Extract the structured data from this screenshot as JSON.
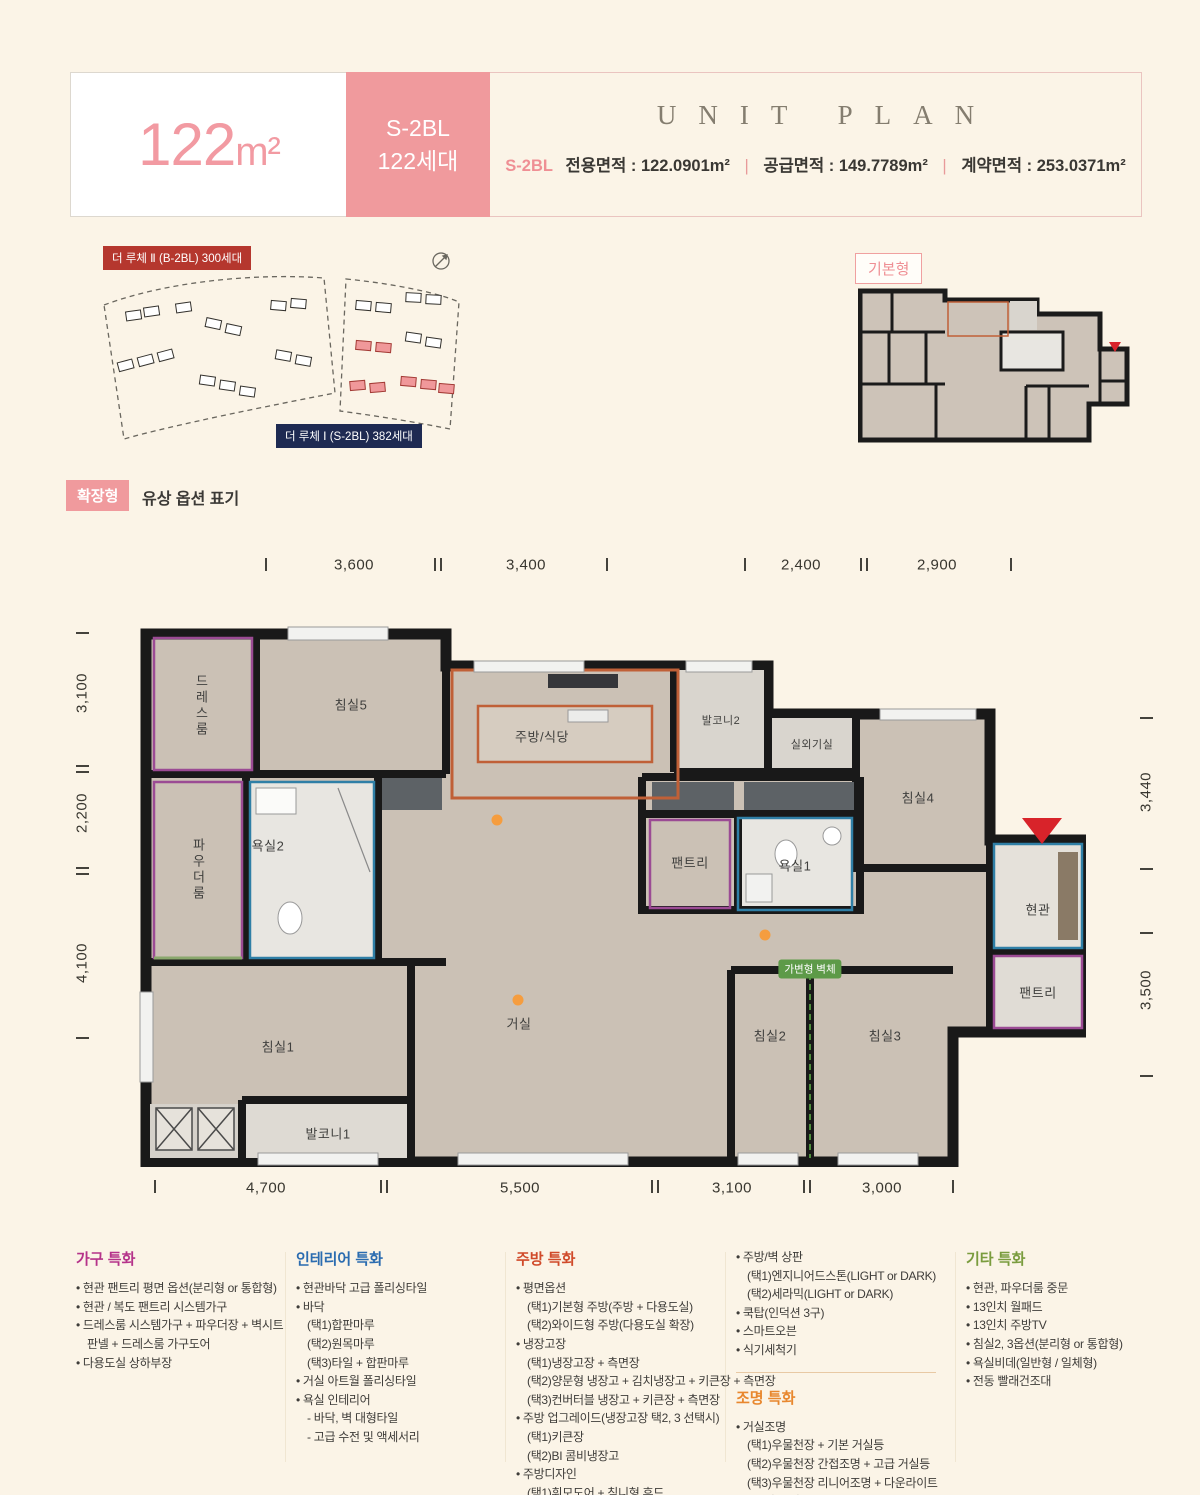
{
  "header": {
    "size_number": "122",
    "size_unit": "m²",
    "block_badge_line1": "S-2BL",
    "block_badge_line2": "122세대",
    "unit_plan_title": "UNIT PLAN",
    "block_code": "S-2BL",
    "areas": [
      {
        "label": "전용면적",
        "value": "122.0901m²"
      },
      {
        "label": "공급면적",
        "value": "149.7789m²"
      },
      {
        "label": "계약면적",
        "value": "253.0371m²"
      }
    ]
  },
  "site_map": {
    "label_block2": "더 루체 Ⅱ (B-2BL) 300세대",
    "label_block1": "더 루체 Ⅰ (S-2BL) 382세대",
    "compass_icon": "compass-icon"
  },
  "basic_type_label": "기본형",
  "option_row": {
    "badge": "확장형",
    "text": "유상 옵션 표기"
  },
  "plan": {
    "dims_top": [
      "3,600",
      "3,400",
      "2,400",
      "2,900"
    ],
    "dims_bottom": [
      "4,700",
      "5,500",
      "3,100",
      "3,000"
    ],
    "dims_left": [
      "3,100",
      "2,200",
      "4,100"
    ],
    "dims_right": [
      "3,440",
      "3,500"
    ],
    "rooms": {
      "dress": "드레스룸",
      "bed5": "침실5",
      "kitchen": "주방/식당",
      "balc2": "발코니2",
      "outdoor": "실외기실",
      "bed4": "침실4",
      "powder": "파우더룸",
      "bath2": "욕실2",
      "pantry1": "팬트리",
      "bath1": "욕실1",
      "entry": "현관",
      "pantry2": "팬트리",
      "bed1": "침실1",
      "living": "거실",
      "bed2": "침실2",
      "bed3": "침실3",
      "balc1": "발코니1"
    },
    "wall_badge": "가변형 벽체"
  },
  "colors": {
    "accent_pink": "#f09a9d",
    "deep_red_label": "#b5372e",
    "navy_label": "#1e2a52",
    "green_badge": "#5d9a48",
    "orange_dot": "#f59d3f",
    "kitchen_outline": "#c06037",
    "purple_outline": "#9b4b94",
    "blue_outline": "#2f7fa6",
    "entry_arrow_red": "#d8232a"
  },
  "features": {
    "columns": [
      {
        "sections": [
          {
            "title": "가구 특화",
            "color": "#b5338a",
            "items": [
              {
                "b": 1,
                "t": "현관 팬트리 평면 옵션(분리형 or 통합형)"
              },
              {
                "b": 1,
                "t": "현관 / 복도 팬트리 시스템가구"
              },
              {
                "b": 1,
                "t": "드레스룸 시스템가구 + 파우더장 + 벽시트판넬 + 드레스룸 가구도어"
              },
              {
                "b": 1,
                "t": "다용도실 상하부장"
              }
            ]
          }
        ]
      },
      {
        "sections": [
          {
            "title": "인테리어 특화",
            "color": "#2b6cb0",
            "items": [
              {
                "b": 1,
                "t": "현관바닥 고급 폴리싱타일"
              },
              {
                "b": 1,
                "t": "바닥"
              },
              {
                "b": 0,
                "t": "(택1)합판마루"
              },
              {
                "b": 0,
                "t": "(택2)원목마루"
              },
              {
                "b": 0,
                "t": "(택3)타일 + 합판마루"
              },
              {
                "b": 1,
                "t": "거실 아트월 폴리싱타일"
              },
              {
                "b": 1,
                "t": "욕실 인테리어"
              },
              {
                "b": 0,
                "t": "- 바닥, 벽 대형타일"
              },
              {
                "b": 0,
                "t": "- 고급 수전 및 액세서리"
              }
            ]
          }
        ]
      },
      {
        "sections": [
          {
            "title": "주방 특화",
            "color": "#d04a2a",
            "items": [
              {
                "b": 1,
                "t": "평면옵션"
              },
              {
                "b": 0,
                "t": "(택1)기본형 주방(주방 + 다용도실)"
              },
              {
                "b": 0,
                "t": "(택2)와이드형 주방(다용도실 확장)"
              },
              {
                "b": 1,
                "t": "냉장고장"
              },
              {
                "b": 0,
                "t": "(택1)냉장고장 + 측면장"
              },
              {
                "b": 0,
                "t": "(택2)양문형 냉장고 + 김치냉장고 + 키큰장 + 측면장"
              },
              {
                "b": 0,
                "t": "(택3)컨버터블 냉장고 + 키큰장 + 측면장"
              },
              {
                "b": 1,
                "t": "주방 업그레이드(냉장고장 택2, 3 선택시)"
              },
              {
                "b": 0,
                "t": "(택1)키큰장"
              },
              {
                "b": 0,
                "t": "(택2)BI 콤비냉장고"
              },
              {
                "b": 1,
                "t": "주방디자인"
              },
              {
                "b": 0,
                "t": "(택1)휘모도어 + 침니형 후드"
              },
              {
                "b": 0,
                "t": "(택2)유리플랩장 + 독립형후드"
              }
            ]
          }
        ]
      },
      {
        "sections": [
          {
            "items": [
              {
                "b": 1,
                "t": "주방/벽 상판"
              },
              {
                "b": 0,
                "t": "(택1)엔지니어드스톤(LIGHT or DARK)"
              },
              {
                "b": 0,
                "t": "(택2)세라믹(LIGHT or DARK)"
              },
              {
                "b": 1,
                "t": "쿡탑(인덕션 3구)"
              },
              {
                "b": 1,
                "t": "스마트오븐"
              },
              {
                "b": 1,
                "t": "식기세척기"
              }
            ]
          },
          {
            "divider": true
          },
          {
            "title": "조명 특화",
            "color": "#e8872e",
            "items": [
              {
                "b": 1,
                "t": "거실조명"
              },
              {
                "b": 0,
                "t": "(택1)우물천장 + 기본 거실등"
              },
              {
                "b": 0,
                "t": "(택2)우물천장 간접조명 + 고급 거실등"
              },
              {
                "b": 0,
                "t": "(택3)우물천장 리니어조명 + 다운라이트"
              },
              {
                "b": 1,
                "t": "단천장 조명"
              },
              {
                "b": 1,
                "t": "주방 고급 라인등 / 식탁등"
              }
            ]
          }
        ]
      },
      {
        "sections": [
          {
            "title": "기타 특화",
            "color": "#7a9c3e",
            "items": [
              {
                "b": 1,
                "t": "현관, 파우더룸 중문"
              },
              {
                "b": 1,
                "t": "13인치 월패드"
              },
              {
                "b": 1,
                "t": "13인치 주방TV"
              },
              {
                "b": 1,
                "t": "침실2, 3옵션(분리형 or 통합형)"
              },
              {
                "b": 1,
                "t": "욕실비데(일반형 / 일체형)"
              },
              {
                "b": 1,
                "t": "전동 빨래건조대"
              }
            ]
          }
        ]
      }
    ]
  }
}
